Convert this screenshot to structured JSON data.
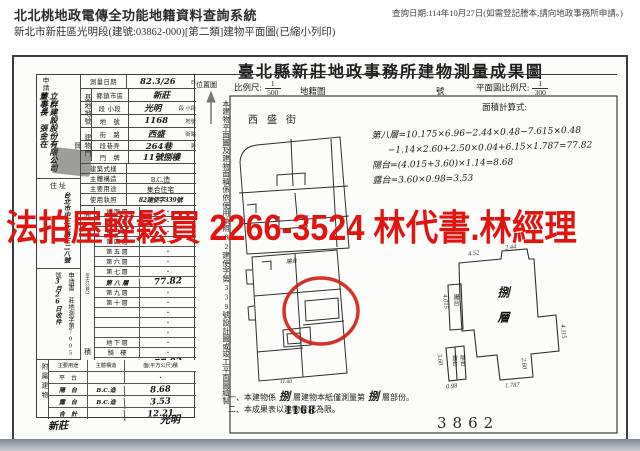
{
  "header": {
    "system_title": "北北桃地政電傳全功能地籍資料查詢系統",
    "subtitle": "新北市新莊區光明段(建號:03862-000)[第二類]建物平面圖(已縮小列印)",
    "query_note": "查詢日期:114年10月27日(如需登記謄本,請向地政事務所申請。)"
  },
  "watermark": {
    "text": "法拍屋輕鬆買 2266-3524 林代書.林經理",
    "color": "#e11510"
  },
  "doc": {
    "title": "臺北縣新莊地政事務所建物測量成果圖",
    "location_map_label": "位置圖",
    "scale_label": "比例尺:",
    "scale_numerator": "1",
    "scale_denominator": "500",
    "cadastral_label": "地籍圖",
    "sheet_label": "號",
    "plan_scale_label": "平面圖比例尺:",
    "plan_scale_numerator": "1",
    "plan_scale_denominator": "300",
    "area_formula_label": "面積計算式:",
    "street_name": "西盛街",
    "side_note": "本建物平面圖及建物面積係依使用執照82建使字第339號設計圖或竣工平面圖繪製",
    "formulas": [
      {
        "t": "第八層=10.175×6.96−2.44×0.48−7.615×0.48"
      },
      {
        "t": "−1.14×2.60+2.50×0.04+6.15×1.787=77.82"
      },
      {
        "t": "陽台=(4.015+3.60)×1.14=8.68"
      },
      {
        "t": "露台=3.60×0.98=3.53"
      }
    ],
    "note1_prefix": "一、本建物係",
    "note1_hw1": "捌",
    "note1_mid": "層建物本紙僅測量第",
    "note1_hw2": "捌",
    "note1_suffix": "層部份。",
    "note2": "二、本成果表以建物登記為限。",
    "parcel_number": "1168",
    "building_number": "3862",
    "district_hw": "新莊",
    "section_hw": "光明"
  },
  "plan": {
    "floor_label": "捌層",
    "balcony_label": "陽台",
    "terrace_label": "露台",
    "balcony2_label": "陽台",
    "map_balcony_hw": "陽台",
    "map_dim_hw": "11.60",
    "dim_top": "4.52",
    "dim_top2": "2.44",
    "dim_left": "4.015",
    "dim_left2": "3.60",
    "dim_bottom_left": "0.98",
    "dim_bottom_mid": "2.60",
    "dim_bottom": "1.787",
    "dim_right": "4.115"
  },
  "form": {
    "applicant_label": "申請人姓名",
    "applicant_name_hw": "立群建設股份有限公司　董事長　張金在",
    "address_label": "住址",
    "address_hw": "台北市中正北路三二八號",
    "application_note": "申請書　莊地測字第7005號",
    "application_date": "3月26日收件",
    "annex_group_label": "附屬建物",
    "area_group_top": "面",
    "area_group_unit": "(平方公尺)",
    "area_group_bottom": "積",
    "group_site_label": "基地地號",
    "group_door_label": "建物門牌",
    "rows_top": [
      {
        "label": "測量日期",
        "value": "82.3/26",
        "suffix": "日",
        "_class": "h14"
      },
      {
        "label": "鄉鎮市區",
        "value": "新莊",
        "suffix": "",
        "_class": "h13 grp"
      },
      {
        "label": "段 小段",
        "value": "光明",
        "suffix": "段 小段",
        "_class": "h13 grp"
      },
      {
        "label": "地　號",
        "value": "1168",
        "suffix": "地號",
        "_class": "h13 grp"
      },
      {
        "label": "街　路",
        "value": "西盛",
        "suffix": "街路",
        "_class": "h13 grp2"
      },
      {
        "label": "段巷弄",
        "value": "264巷",
        "suffix": "弄",
        "_class": "h10 grp2"
      },
      {
        "label": "門　牌",
        "value": "11號捌樓",
        "suffix": "",
        "_class": "h13 grp2"
      },
      {
        "label": "建築式樣",
        "value": "",
        "suffix": "",
        "_class": "h10"
      },
      {
        "label": "主體構造",
        "value": "B.C.造",
        "suffix": "",
        "_class": "h10 pr"
      },
      {
        "label": "主要用途",
        "value": "集合住宅",
        "suffix": "",
        "_class": "h10 pr"
      },
      {
        "label": "使用執照",
        "value": "82建使字339號",
        "suffix": "",
        "_class": "h12 uz"
      }
    ],
    "floors": [
      {
        "label": "地 面 層",
        "value": "・",
        "_class": ""
      },
      {
        "label": "第 二 層",
        "value": "・",
        "_class": ""
      },
      {
        "label": "第 三 層",
        "value": "・",
        "_class": ""
      },
      {
        "label": "第 四 層",
        "value": "・",
        "_class": ""
      },
      {
        "label": "第 五 層",
        "value": "・",
        "_class": ""
      },
      {
        "label": "第 六 層",
        "value": "・",
        "_class": ""
      },
      {
        "label": "第 七 層",
        "value": "・",
        "_class": ""
      },
      {
        "label": "第 八 層",
        "value": "77.82",
        "_class": "hw"
      },
      {
        "label": "第 九 層",
        "value": "・",
        "_class": ""
      },
      {
        "label": "第 十 層",
        "value": "・",
        "_class": ""
      },
      {
        "label": "",
        "value": "・",
        "_class": ""
      },
      {
        "label": "",
        "value": "・",
        "_class": ""
      },
      {
        "label": "",
        "value": "・",
        "_class": ""
      },
      {
        "label": "地 下 層",
        "value": "・",
        "_class": ""
      },
      {
        "label": "騎　樓",
        "value": "・",
        "_class": ""
      },
      {
        "label": "合　計",
        "value": "77.82",
        "_class": "hw"
      }
    ],
    "annex_header": {
      "use": "主要用途",
      "structure": "主體構造",
      "area": "面(平方公尺)積",
      "_class": "head"
    },
    "annex_rows": [
      {
        "use": "平　台",
        "structure": "",
        "area": "・",
        "_class": ""
      },
      {
        "use": "陽　台",
        "structure": "B.C.造",
        "area": "8.68",
        "_class": "hw"
      },
      {
        "use": "露　台",
        "structure": "B.C.造",
        "area": "3.53",
        "_class": "hw"
      },
      {
        "use": "合　計",
        "structure": "",
        "area": "12.21",
        "_class": "hw"
      }
    ]
  }
}
